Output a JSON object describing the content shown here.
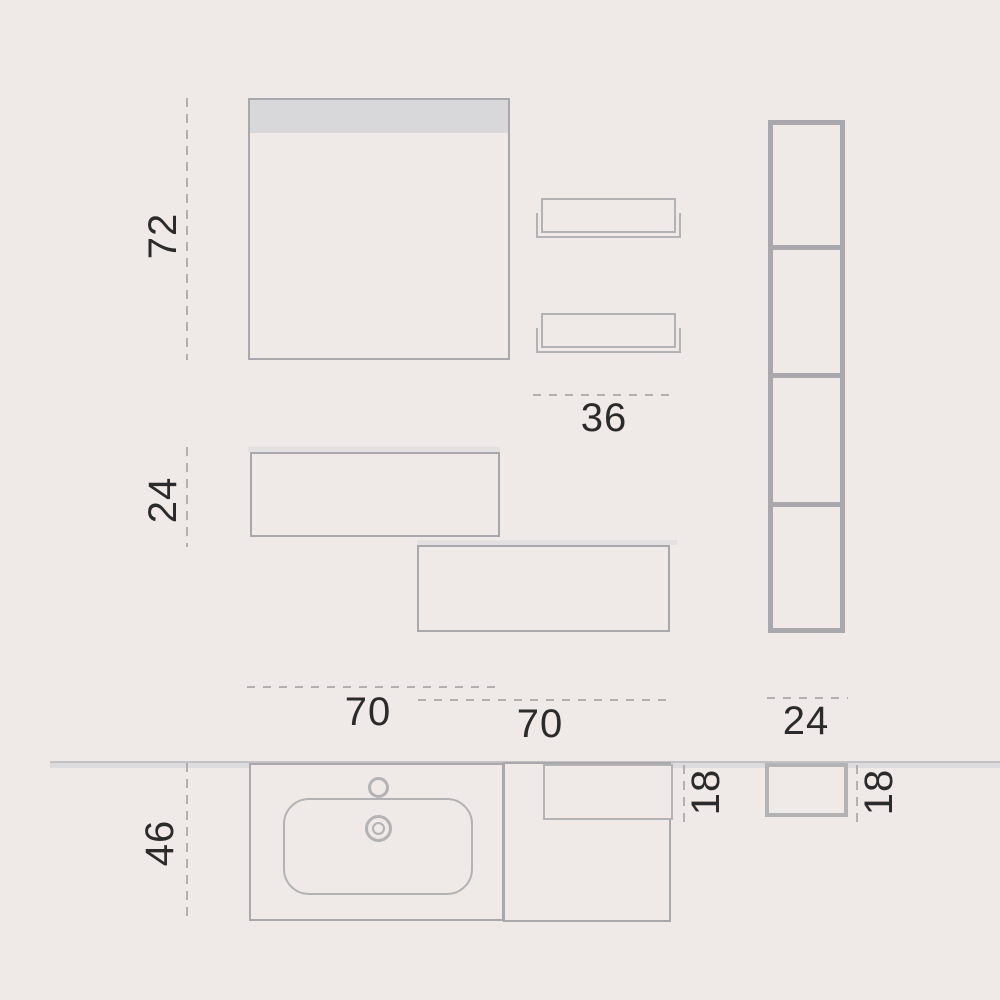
{
  "diagram": {
    "type": "furniture-dimension-drawing",
    "subject": "bathroom-vanity-set-elevation-and-plan",
    "colors": {
      "background": "#efe9e7",
      "line": "#a9a8ac",
      "line_light": "#b3b2b5",
      "mirror_band": "#d8d8db",
      "wall_band": "#dcdbde",
      "wall_band_edge": "#c2c1c4",
      "cabinet_top_strip": "#e2e0e1",
      "dash": "#b5b0b0",
      "text": "#2b2b2b"
    },
    "dimensions": {
      "mirror_height": "72",
      "wall_cabinet_height": "24",
      "wall_shelf_width": "36",
      "vanity_width": "70",
      "side_cabinet_width": "70",
      "column_width": "24",
      "vanity_depth": "46",
      "side_shelf_depth": "18",
      "column_depth": "18"
    }
  }
}
